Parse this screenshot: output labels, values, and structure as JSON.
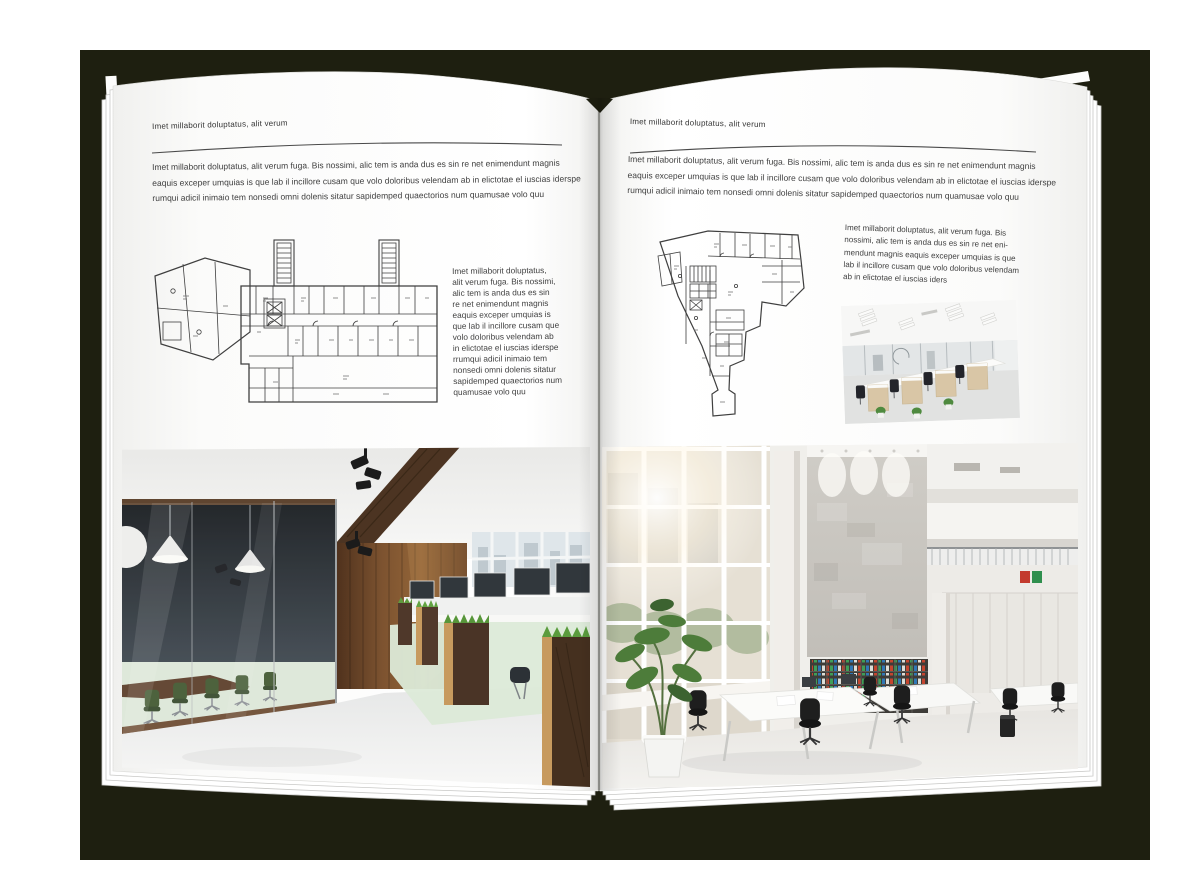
{
  "palette": {
    "backdrop": "#1e1f10",
    "page": "#ffffff",
    "text": "#3f3f3f",
    "rule": "#4a4a4a"
  },
  "left_page": {
    "kicker": "Imet millaborit doluptatus, alit verum",
    "intro_lines": [
      "Imet millaborit doluptatus, alit verum fuga. Bis nossimi, alic tem is anda dus es sin re net enimendunt magnis",
      "eaquis exceper umquias is que lab il incillore cusam que volo doloribus velendam ab in elictotae el iuscias iderspe",
      "rumqui adicil inimaio tem nonsedi omni dolenis sitatur sapidemped quaectorios num quamusae volo quu"
    ],
    "side_lines": [
      "Imet millaborit doluptatus,",
      "alit verum fuga. Bis nossimi,",
      "alic tem is anda dus es sin",
      "re net enimendunt magnis",
      "eaquis exceper umquias is",
      "que lab il incillore cusam que",
      "volo doloribus velendam ab",
      "in elictotae el iuscias iderspe",
      "rrumqui adicil inimaio tem",
      "nonsedi omni dolenis sitatur",
      "sapidemped quaectorios num",
      "quamusae volo quu"
    ]
  },
  "right_page": {
    "kicker": "Imet millaborit doluptatus, alit verum",
    "intro_lines": [
      "Imet millaborit doluptatus, alit verum fuga. Bis nossimi, alic tem is anda dus es sin re net enimendunt magnis",
      "eaquis exceper umquias is que lab il incillore cusam que volo doloribus velendam ab in elictotae el iuscias iderspe",
      "rumqui adicil inimaio tem nonsedi omni dolenis sitatur sapidemped quaectorios num quamusae volo quu"
    ],
    "side_lines": [
      "Imet millaborit doluptatus, alit verum fuga. Bis",
      "nossimi, alic tem is anda dus es sin re net eni-",
      "mendunt magnis eaquis exceper umquias is que",
      "lab il incillore cusam que volo doloribus velendam",
      "ab in elictotae el iuscias iders"
    ]
  }
}
